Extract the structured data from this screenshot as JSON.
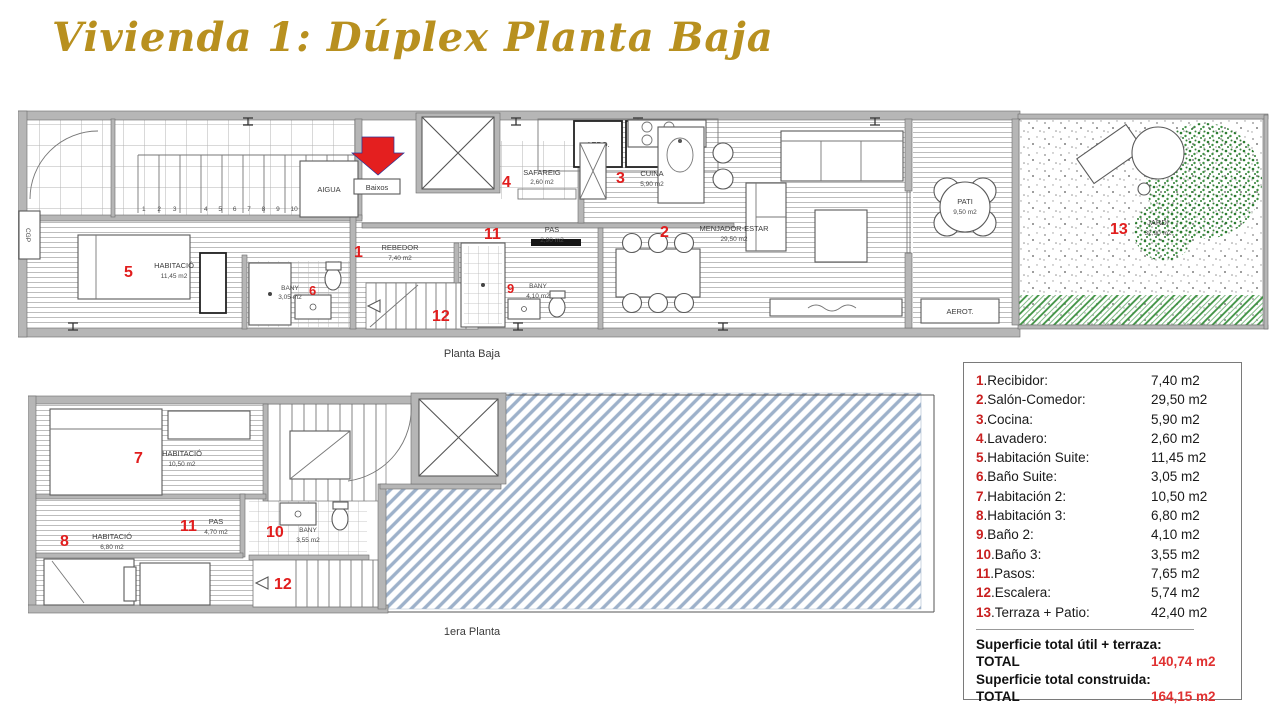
{
  "title": "Vivienda 1: Dúplex Planta Baja",
  "colors": {
    "title_gold": "#b8901f",
    "plan_number_red": "#e11d1d",
    "legend_number_red": "#c92121",
    "total_value_red": "#e03131",
    "hatch_blue": "#9db1ca",
    "tree_green": "#2e7d32",
    "grass_green": "#3c9140",
    "wall_gray": "#b6b6b6"
  },
  "pb": {
    "caption": "Planta Baja",
    "rooms": [
      {
        "num": "1",
        "name": "REBEDOR",
        "area": "7,40 m2"
      },
      {
        "num": "2",
        "name": "MENJADOR-ESTAR",
        "area": "29,50 m2"
      },
      {
        "num": "3",
        "name": "CUINA",
        "area": "5,90 m2"
      },
      {
        "num": "4",
        "name": "SAFAREIG",
        "area": "2,60 m2"
      },
      {
        "num": "5",
        "name": "HABITACIÓ",
        "area": "11,45 m2"
      },
      {
        "num": "6",
        "name": "BANY",
        "area": "3,05 m2"
      },
      {
        "num": "9",
        "name": "BANY",
        "area": "4,10 m2"
      },
      {
        "num": "11",
        "name": "PAS",
        "area": "2,90 m2"
      },
      {
        "num": "12",
        "name": "",
        "area": ""
      },
      {
        "num": "13",
        "name": "JARDÍ",
        "area": "32,90 m2"
      },
      {
        "num": "",
        "name": "PATI",
        "area": "9,50 m2"
      }
    ],
    "misc": {
      "aigua": "AIGUA",
      "aero": "AERO.",
      "rent": "RENT.",
      "aerot": "AEROT.",
      "baixos": "Baixos",
      "cgp": "CGP",
      "steps_a": "1 2 3",
      "steps_b": "4 5 6 7 8 9 10"
    }
  },
  "pp": {
    "caption": "1era Planta",
    "rooms": [
      {
        "num": "7",
        "name": "HABITACIÓ",
        "area": "10,50 m2"
      },
      {
        "num": "8",
        "name": "HABITACIÓ",
        "area": "6,80 m2"
      },
      {
        "num": "10",
        "name": "BANY",
        "area": "3,55 m2"
      },
      {
        "num": "11",
        "name": "PAS",
        "area": "4,70 m2"
      },
      {
        "num": "12",
        "name": "",
        "area": ""
      }
    ]
  },
  "legend": {
    "rows": [
      {
        "num": "1",
        "label": ".Recibidor:",
        "value": "7,40 m2"
      },
      {
        "num": "2",
        "label": ".Salón-Comedor:",
        "value": "29,50 m2"
      },
      {
        "num": "3",
        "label": ".Cocina:",
        "value": "5,90 m2"
      },
      {
        "num": "4",
        "label": ".Lavadero:",
        "value": "2,60 m2"
      },
      {
        "num": "5",
        "label": ".Habitación Suite:",
        "value": "11,45 m2"
      },
      {
        "num": "6",
        "label": ".Baño Suite:",
        "value": "3,05 m2"
      },
      {
        "num": "7",
        "label": ".Habitación 2:",
        "value": "10,50 m2"
      },
      {
        "num": "8",
        "label": ".Habitación 3:",
        "value": "6,80 m2"
      },
      {
        "num": "9",
        "label": ".Baño 2:",
        "value": "4,10 m2"
      },
      {
        "num": "10",
        "label": ".Baño 3:",
        "value": "3,55 m2"
      },
      {
        "num": "11",
        "label": ".Pasos:",
        "value": "7,65 m2"
      },
      {
        "num": "12",
        "label": ".Escalera:",
        "value": "5,74 m2"
      },
      {
        "num": "13",
        "label": ".Terraza + Patio:",
        "value": "42,40 m2"
      }
    ],
    "summary": [
      {
        "label": "Superficie total útil + terraza:",
        "value": ""
      },
      {
        "label": "TOTAL",
        "value": "140,74 m2"
      },
      {
        "label": "Superficie total construida:",
        "value": ""
      },
      {
        "label": "TOTAL",
        "value": "164,15 m2"
      }
    ]
  }
}
